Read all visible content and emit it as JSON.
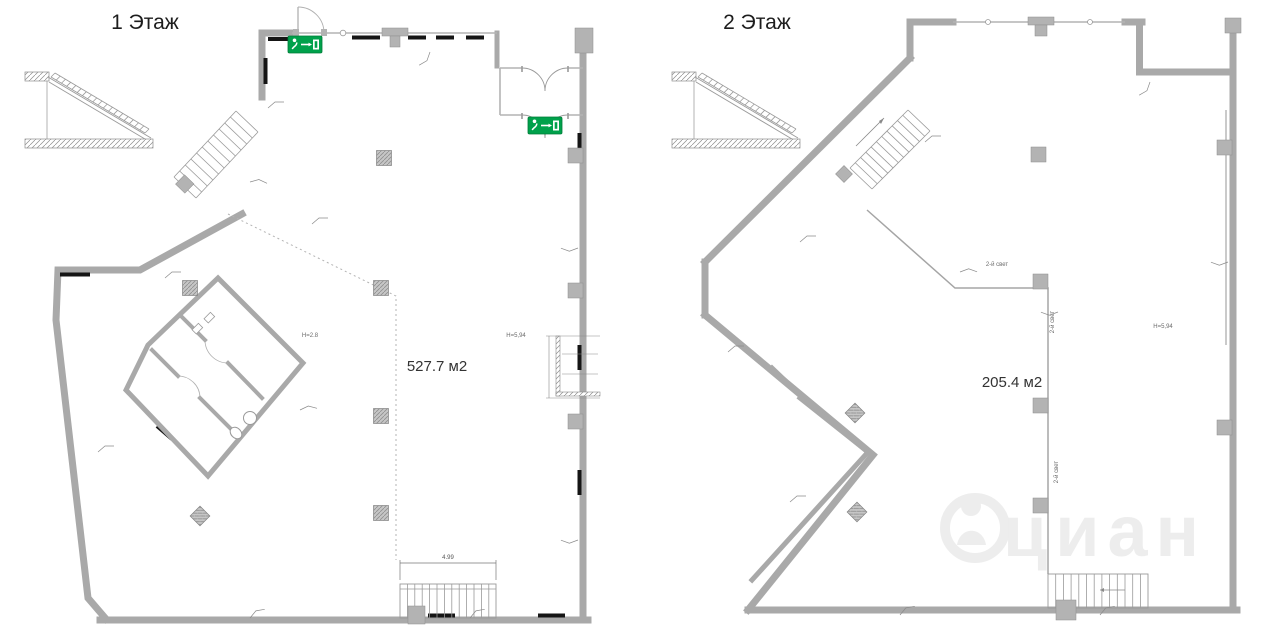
{
  "page": {
    "width": 1280,
    "height": 642,
    "background": "#ffffff"
  },
  "colors": {
    "wall_gray": "#a9a9a9",
    "thin_wall_gray": "#b4b4b4",
    "window_bar_black": "#151515",
    "column_gray": "#b3b3b3",
    "exit_sign_green": "#00a14b",
    "title_text": "#1d1d1d",
    "watermark_gray": "#ededed"
  },
  "floor1": {
    "title": "1 Этаж",
    "area_label": "527.7 м2",
    "height_label_mezzanine": "Н=2.8",
    "height_label_main": "Н=5,94",
    "stair_dimension": "4.99"
  },
  "floor2": {
    "title": "2 Этаж",
    "area_label": "205.4 м2",
    "height_label": "Н=5,94",
    "double_height_label_1": "2-й свет",
    "double_height_label_2": "2-й свет",
    "double_height_label_3": "2-й свет"
  },
  "watermark": {
    "text": "циан"
  }
}
